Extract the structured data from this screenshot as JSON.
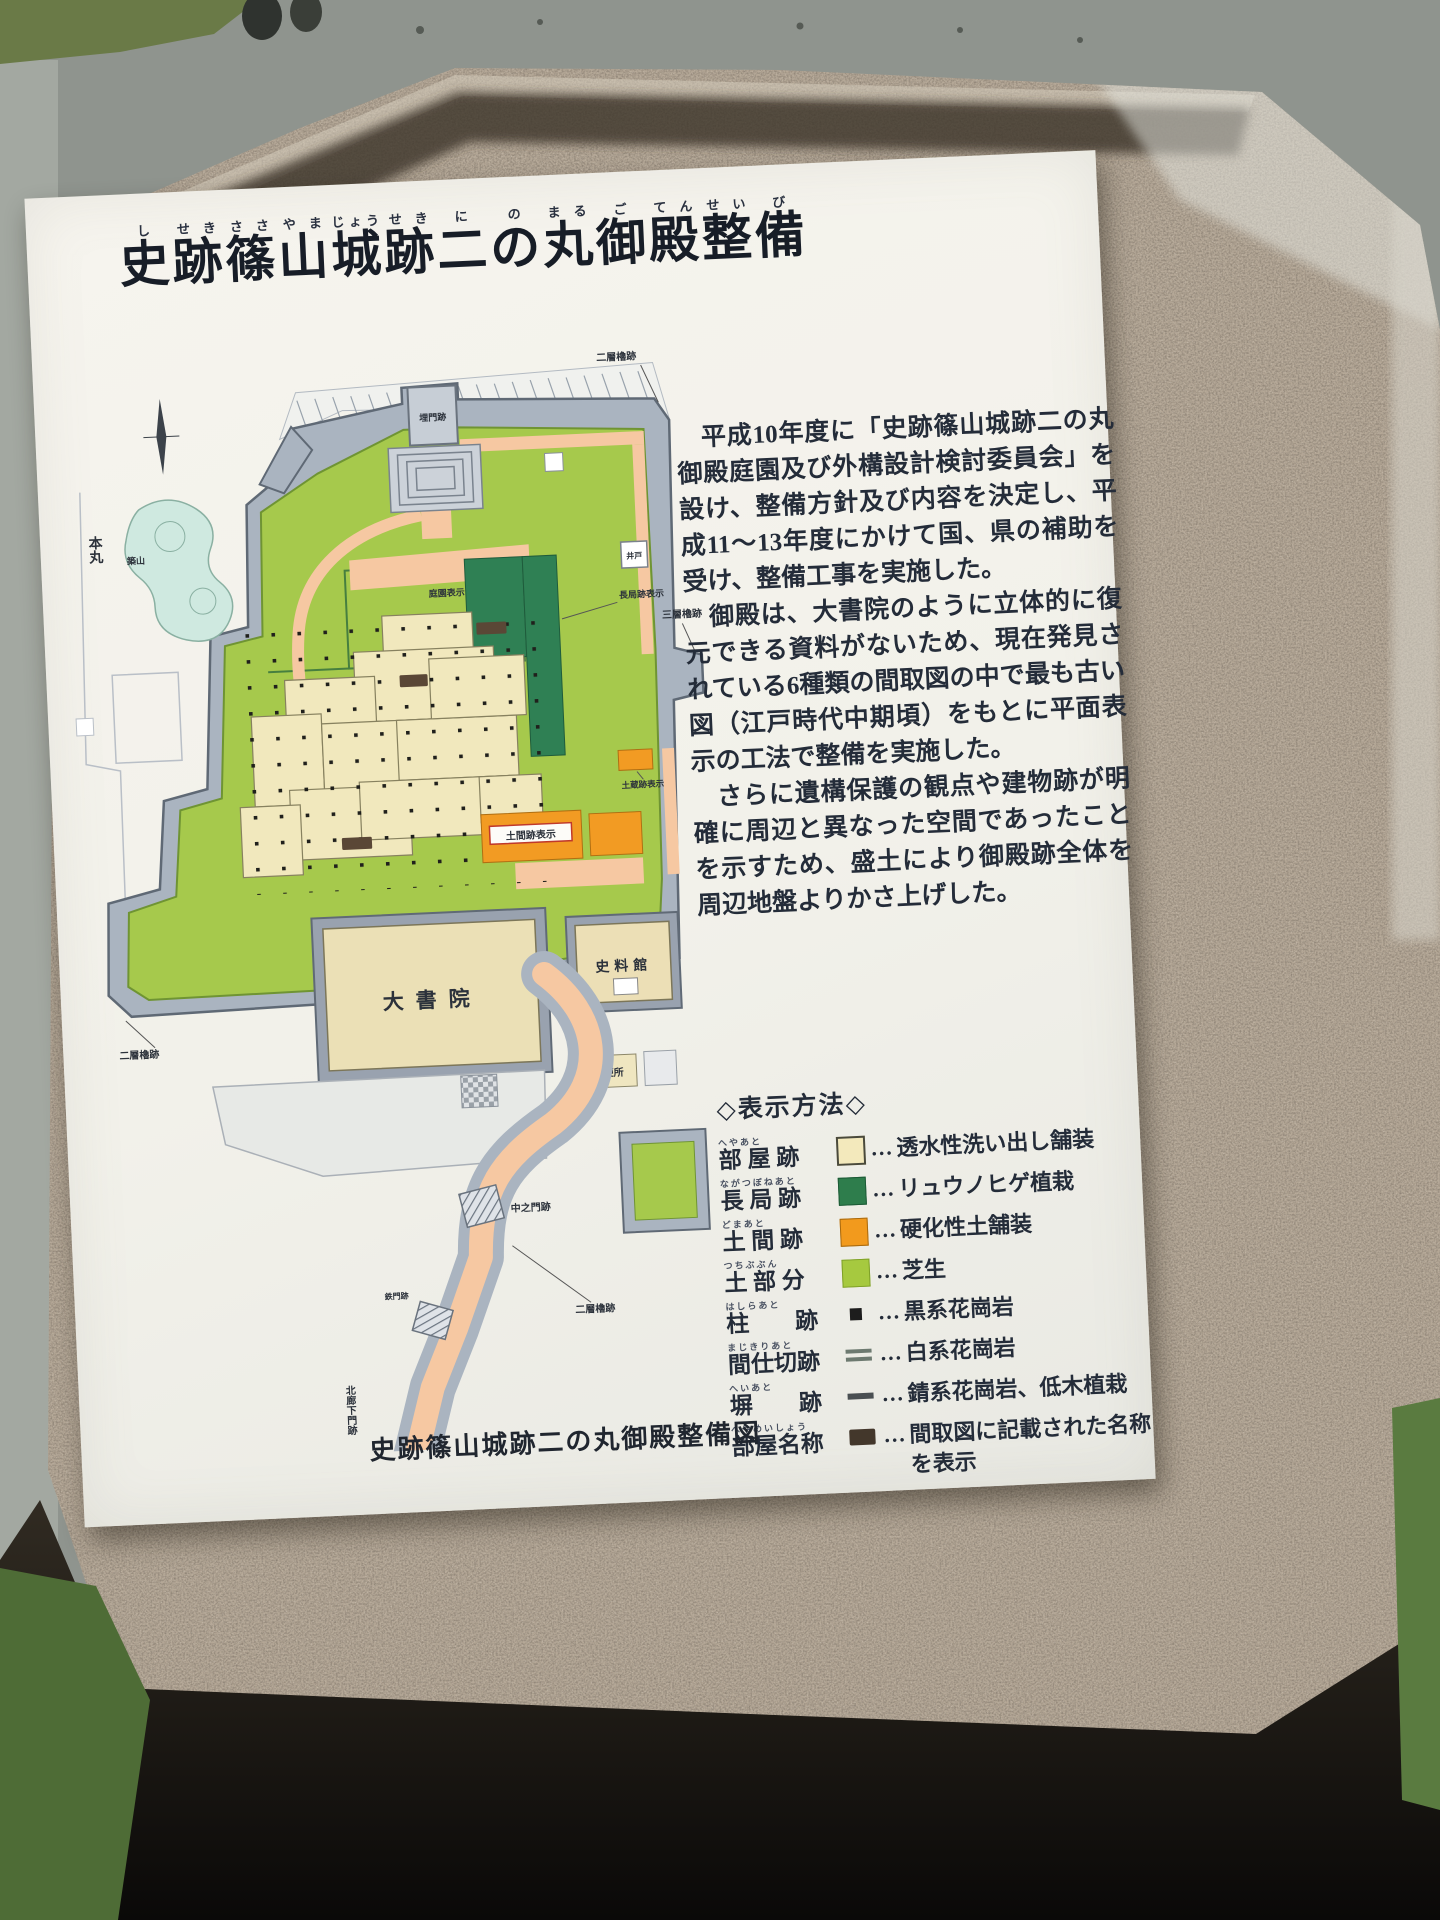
{
  "sign": {
    "title": {
      "full_text": "史跡篠山城跡二の丸御殿整備",
      "full_furigana": "しせきささやまじょうせきにのまるごてんせいび",
      "segments": [
        {
          "k": "史",
          "r": "し"
        },
        {
          "k": "跡",
          "r": "せき"
        },
        {
          "k": "篠",
          "r": "ささ"
        },
        {
          "k": "山",
          "r": "やま"
        },
        {
          "k": "城",
          "r": "じょう"
        },
        {
          "k": "跡",
          "r": "せき"
        },
        {
          "k": "二",
          "r": "に"
        },
        {
          "k": "の",
          "r": "の"
        },
        {
          "k": "丸",
          "r": "まる"
        },
        {
          "k": "御",
          "r": "ご"
        },
        {
          "k": "殿",
          "r": "てん"
        },
        {
          "k": "整",
          "r": "せい"
        },
        {
          "k": "備",
          "r": "び"
        }
      ]
    },
    "paragraphs": [
      "平成10年度に「史跡篠山城跡二の丸御殿庭園及び外構設計検討委員会」を設け、整備方針及び内容を決定し、平成11〜13年度にかけて国、県の補助を受け、整備工事を実施した。",
      "御殿は、大書院のように立体的に復元できる資料がないため、現在発見されている6種類の間取図の中で最も古い図（江戸時代中期頃）をもとに平面表示の工法で整備を実施した。",
      "さらに遺構保護の観点や建物跡が明確に周辺と異なった空間であったことを示すため、盛土により御殿跡全体を周辺地盤よりかさ上げした。"
    ],
    "legend": {
      "heading": "◇表示方法◇",
      "leader": "…",
      "items": [
        {
          "label": "部 屋 跡",
          "reading": "へやあと",
          "swatch": "room",
          "color": "#f3e9bc",
          "desc": "透水性洗い出し舗装"
        },
        {
          "label": "長 局 跡",
          "reading": "ながつぼねあと",
          "swatch": "nagatsubone",
          "color": "#2e7d4c",
          "desc": "リュウノヒゲ植栽"
        },
        {
          "label": "土 間 跡",
          "reading": "どまあと",
          "swatch": "doma",
          "color": "#f29a1d",
          "desc": "硬化性土舗装"
        },
        {
          "label": "土 部 分",
          "reading": "つちぶぶん",
          "swatch": "lawn",
          "color": "#a6c93f",
          "desc": "芝生"
        },
        {
          "label": "柱　　跡",
          "reading": "はしらあと",
          "swatch": "pillar",
          "color": "#1d1d1d",
          "desc": "黒系花崗岩"
        },
        {
          "label": "間仕切跡",
          "reading": "まじきりあと",
          "swatch": "partition",
          "color": "#6d7a70",
          "desc": "白系花崗岩"
        },
        {
          "label": "塀　　跡",
          "reading": "へいあと",
          "swatch": "fence",
          "color": "#4a4f52",
          "desc": "錆系花崗岩、低木植栽"
        },
        {
          "label": "部屋名称",
          "reading": "へやめいしょう",
          "swatch": "nametag",
          "color": "#43372b",
          "desc": "間取図に記載された名称を表示"
        }
      ]
    },
    "caption": "史跡篠山城跡二の丸御殿整備図",
    "map": {
      "palette": {
        "wall": "#aab4c0",
        "lawn": "#a6c94c",
        "path": "#f6c8a2",
        "room": "#f1e8bd",
        "doma_orange": "#f29b23",
        "nagatsubone_green": "#2f8054",
        "pond": "#cfe9e0",
        "modern": "#e7e9e6"
      },
      "labels": {
        "honmaru": "本丸",
        "top_gate": "埋門跡",
        "yagura2_top_right": "二層櫓跡",
        "yagura3_right": "三層櫓跡",
        "yagura2_bottom_left": "二層櫓跡",
        "yagura2_bottom_right": "二層櫓跡",
        "nakanomon": "中之門跡",
        "tetsumon": "鉄門跡",
        "kita_roka_mon": "北廊下門跡",
        "oshoin": "大書院",
        "shiryokan": "史料館",
        "ido": "井戸",
        "benjo": "便所",
        "tsukiyama": "築山",
        "teien": "庭園表示",
        "nagatsubone": "長局跡表示",
        "dozo": "土蔵跡表示",
        "doma": "土間跡表示"
      }
    }
  }
}
